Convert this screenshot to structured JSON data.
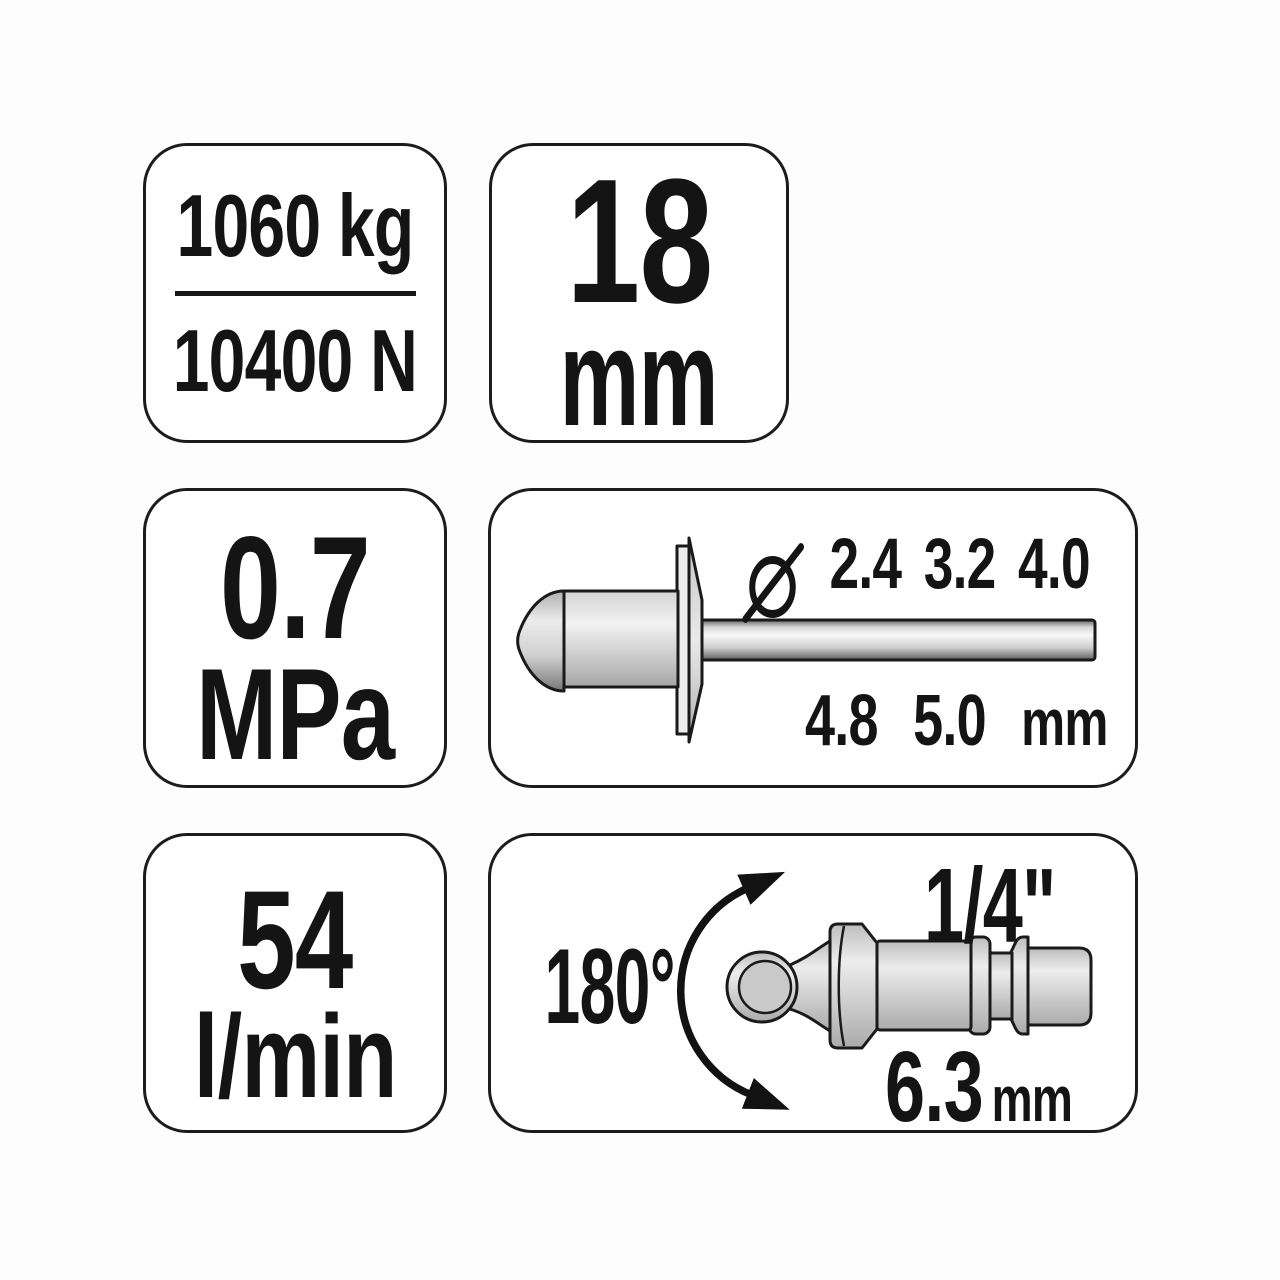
{
  "force": {
    "primary": "1060 kg",
    "secondary": "10400 N"
  },
  "stroke": {
    "value": "18",
    "unit": "mm"
  },
  "pressure": {
    "value": "0.7",
    "unit": "MPa"
  },
  "rivet": {
    "diameter_symbol": "⌀",
    "row1": [
      "2.4",
      "3.2",
      "4.0"
    ],
    "row2": [
      "4.8",
      "5.0"
    ],
    "unit": "mm"
  },
  "airflow": {
    "value": "54",
    "unit": "l/min"
  },
  "connector": {
    "rotation": "180°",
    "thread": "1/4\"",
    "diameter": "6.3",
    "unit": "mm"
  },
  "colors": {
    "ink": "#141414",
    "border": "#1c1c1c",
    "panel": "#ffffff",
    "metal_light": "#f1f1f1",
    "metal_mid": "#c6c6c6",
    "metal_dark": "#6f6f6f"
  }
}
